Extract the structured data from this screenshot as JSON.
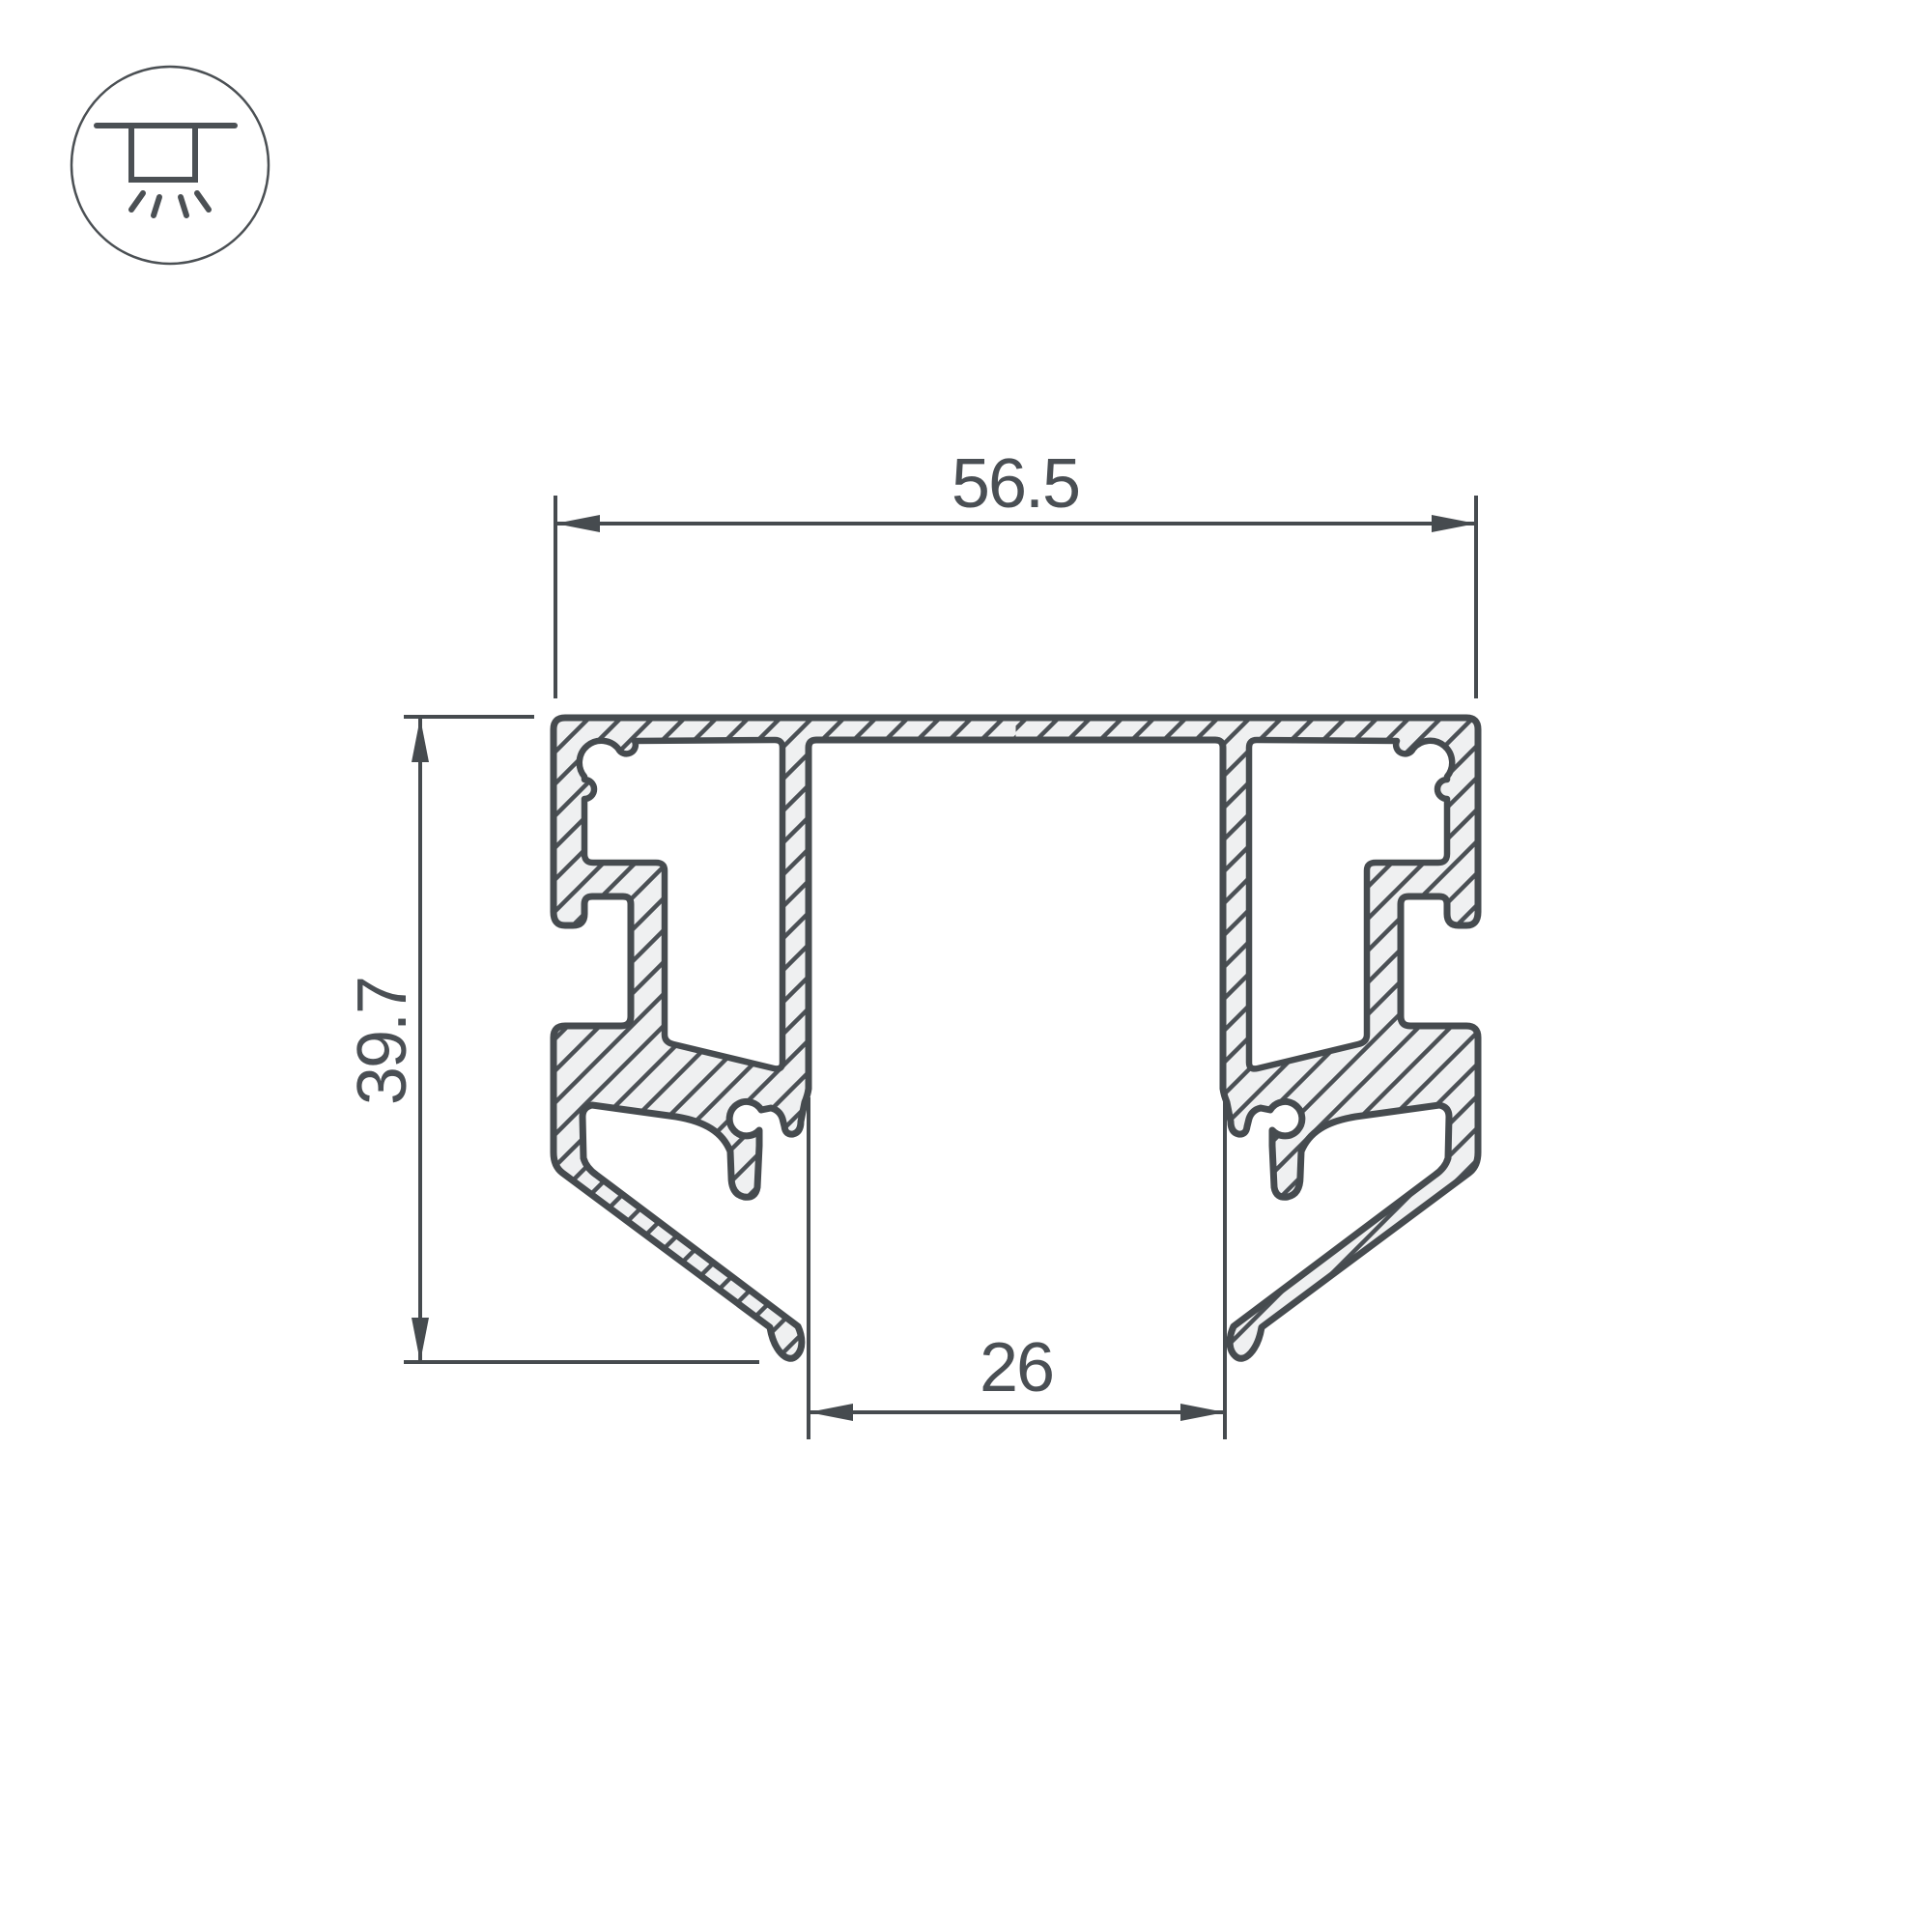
{
  "drawing": {
    "kind": "technical-cross-section",
    "subject": "aluminium LED profile cross-section with hatched walls, side C-slots, screw ports and angled bottom legs"
  },
  "icon": {
    "name": "ceiling-recessed-light-icon"
  },
  "dimensions": {
    "overall_width": "56.5",
    "overall_height": "39.7",
    "opening_width": "26"
  },
  "colors": {
    "line": "#464b4f",
    "profile_fill": "#eff0f1",
    "text": "#4a4f54",
    "icon_line": "#4b5054",
    "background": "#ffffff"
  }
}
